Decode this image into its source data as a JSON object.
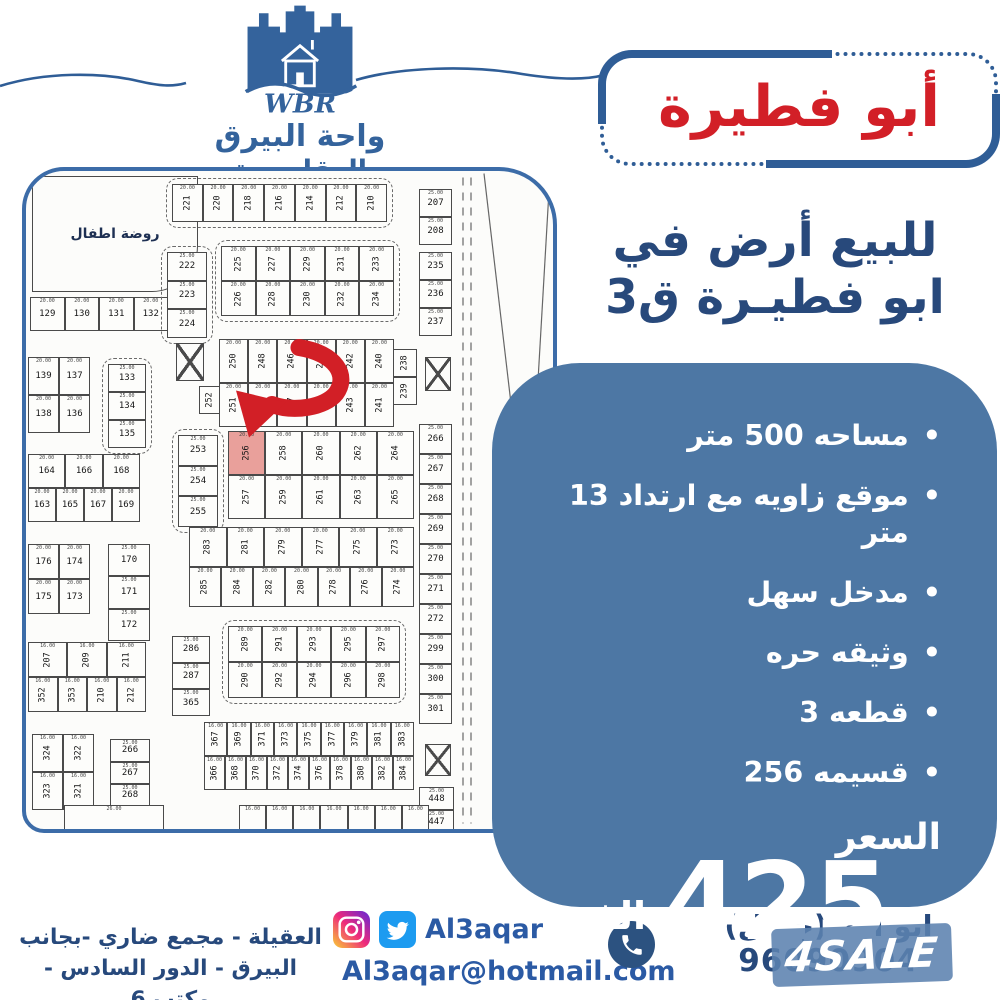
{
  "brand": {
    "initials": "WBR",
    "name_line1": "واحة البيرق",
    "name_line2": "العقاريـــة"
  },
  "title_box": {
    "text": "أبو فطيرة"
  },
  "headline": {
    "line1": "للبيع أرض في",
    "line2": "ابو فطيـرة ق3"
  },
  "panel": {
    "bullets": [
      "مساحه 500 متر",
      "موقع زاويه مع ارتداد 13 متر",
      "مدخل سهل",
      "وثيقه حره",
      "قطعه 3",
      "قسيمه 256"
    ],
    "bullet_symbol": "•",
    "price_label": "السعر",
    "price_value": "425",
    "price_unit": "الف"
  },
  "map": {
    "kindergarten_label": "روضة اطفال",
    "highlighted_plot": "256",
    "blocks": [
      {
        "type": "label",
        "x": 6,
        "y": 5,
        "w": 166,
        "h": 116,
        "label": "روضة اطفال",
        "radius": "0 0 46px 0"
      },
      {
        "x": 146,
        "y": 13,
        "w": 215,
        "h": 38,
        "rotate": true,
        "dim": "20.00",
        "dashed": true,
        "rows": [
          [
            "221",
            "220",
            "218",
            "216",
            "214",
            "212",
            "210"
          ]
        ]
      },
      {
        "x": 4,
        "y": 126,
        "w": 138,
        "h": 34,
        "dim": "20.00",
        "rows": [
          [
            "129",
            "130",
            "131",
            "132"
          ]
        ]
      },
      {
        "x": 2,
        "y": 186,
        "w": 62,
        "h": 76,
        "dim": "20.00",
        "rows": [
          [
            "139",
            "137"
          ],
          [
            "138",
            "136"
          ]
        ]
      },
      {
        "x": 141,
        "y": 81,
        "w": 40,
        "h": 86,
        "dim": "25.00",
        "dashed": true,
        "rows": [
          [
            "222"
          ],
          [
            "223"
          ],
          [
            "224"
          ]
        ]
      },
      {
        "x": 195,
        "y": 75,
        "w": 173,
        "h": 70,
        "rotate": true,
        "dim": "20.00",
        "dashed": true,
        "rows": [
          [
            "225",
            "227",
            "229",
            "231",
            "233"
          ],
          [
            "226",
            "228",
            "230",
            "232",
            "234"
          ]
        ]
      },
      {
        "x": 82,
        "y": 193,
        "w": 38,
        "h": 84,
        "dim": "25.00",
        "dashed": true,
        "rows": [
          [
            "133"
          ],
          [
            "134"
          ],
          [
            "135"
          ]
        ]
      },
      {
        "x": 2,
        "y": 283,
        "w": 112,
        "h": 68,
        "dim": "20.00",
        "rows": [
          [
            "164",
            "166",
            "168"
          ],
          [
            "163",
            "165",
            "167",
            "169"
          ]
        ]
      },
      {
        "x": 2,
        "y": 373,
        "w": 62,
        "h": 70,
        "dim": "20.00",
        "rows": [
          [
            "176",
            "174"
          ],
          [
            "175",
            "173"
          ]
        ]
      },
      {
        "x": 82,
        "y": 373,
        "w": 42,
        "h": 97,
        "dim": "25.00",
        "rows": [
          [
            "170"
          ],
          [
            "171"
          ],
          [
            "172"
          ]
        ]
      },
      {
        "x": 2,
        "y": 471,
        "w": 118,
        "h": 70,
        "rotate": true,
        "dim": "16.00",
        "rows": [
          [
            "207",
            "209",
            "211"
          ],
          [
            "352",
            "353",
            "210",
            "212"
          ]
        ]
      },
      {
        "x": 6,
        "y": 563,
        "w": 62,
        "h": 76,
        "rotate": true,
        "dim": "16.00",
        "rows": [
          [
            "324",
            "322"
          ],
          [
            "323",
            "321"
          ]
        ]
      },
      {
        "x": 84,
        "y": 568,
        "w": 40,
        "h": 90,
        "dim": "25.00",
        "rows": [
          [
            "266"
          ],
          [
            "267"
          ],
          [
            "268"
          ],
          [
            "269"
          ]
        ]
      },
      {
        "type": "xbox",
        "x": 150,
        "y": 172,
        "w": 28,
        "h": 38
      },
      {
        "x": 173,
        "y": 215,
        "w": 22,
        "h": 28,
        "rotate": true,
        "rows": [
          [
            "252"
          ]
        ]
      },
      {
        "x": 193,
        "y": 168,
        "w": 175,
        "h": 88,
        "rotate": true,
        "dim": "20.00",
        "rows": [
          [
            "250",
            "248",
            "246",
            "244",
            "242",
            "240"
          ],
          [
            "251",
            "249",
            "247",
            "245",
            "243",
            "241"
          ]
        ]
      },
      {
        "x": 367,
        "y": 178,
        "w": 24,
        "h": 56,
        "rotate": true,
        "rows": [
          [
            "238"
          ],
          [
            "239"
          ]
        ]
      },
      {
        "x": 152,
        "y": 264,
        "w": 40,
        "h": 92,
        "dim": "25.00",
        "dashed": true,
        "rows": [
          [
            "253"
          ],
          [
            "254"
          ],
          [
            "255"
          ]
        ]
      },
      {
        "x": 202,
        "y": 260,
        "w": 186,
        "h": 88,
        "rotate": true,
        "dim": "20.00",
        "rows": [
          [
            "256",
            "258",
            "260",
            "262",
            "264"
          ],
          [
            "257",
            "259",
            "261",
            "263",
            "265"
          ]
        ]
      },
      {
        "x": 163,
        "y": 356,
        "w": 225,
        "h": 80,
        "rotate": true,
        "dim": "20.00",
        "rows": [
          [
            "283",
            "281",
            "279",
            "277",
            "275",
            "273"
          ],
          [
            "285",
            "284",
            "282",
            "280",
            "278",
            "276",
            "274"
          ]
        ]
      },
      {
        "x": 146,
        "y": 465,
        "w": 38,
        "h": 80,
        "dim": "25.00",
        "rows": [
          [
            "286"
          ],
          [
            "287"
          ],
          [
            "365"
          ]
        ]
      },
      {
        "x": 202,
        "y": 455,
        "w": 172,
        "h": 72,
        "rotate": true,
        "dim": "20.00",
        "dashed": true,
        "rows": [
          [
            "289",
            "291",
            "293",
            "295",
            "297"
          ],
          [
            "290",
            "292",
            "294",
            "296",
            "298"
          ]
        ]
      },
      {
        "x": 178,
        "y": 551,
        "w": 210,
        "h": 68,
        "rotate": true,
        "dim": "16.00",
        "rows": [
          [
            "367",
            "369",
            "371",
            "373",
            "375",
            "377",
            "379",
            "381",
            "383"
          ],
          [
            "366",
            "368",
            "370",
            "372",
            "374",
            "376",
            "378",
            "380",
            "382",
            "384"
          ]
        ]
      },
      {
        "x": 393,
        "y": 18,
        "w": 33,
        "h": 56,
        "dim": "25.00",
        "rows": [
          [
            "207"
          ],
          [
            "208"
          ]
        ]
      },
      {
        "x": 393,
        "y": 81,
        "w": 33,
        "h": 84,
        "dim": "25.00",
        "rows": [
          [
            "235"
          ],
          [
            "236"
          ],
          [
            "237"
          ]
        ]
      },
      {
        "type": "xbox",
        "x": 399,
        "y": 186,
        "w": 26,
        "h": 34
      },
      {
        "x": 393,
        "y": 253,
        "w": 33,
        "h": 300,
        "dim": "25.00",
        "rows": [
          [
            "266"
          ],
          [
            "267"
          ],
          [
            "268"
          ],
          [
            "269"
          ],
          [
            "270"
          ],
          [
            "271"
          ],
          [
            "272"
          ],
          [
            "299"
          ],
          [
            "300"
          ],
          [
            "301"
          ]
        ]
      },
      {
        "type": "xbox",
        "x": 399,
        "y": 573,
        "w": 26,
        "h": 32
      },
      {
        "x": 393,
        "y": 616,
        "w": 35,
        "h": 46,
        "dim": "25.00",
        "rows": [
          [
            "448"
          ],
          [
            "447"
          ]
        ]
      },
      {
        "x": 213,
        "y": 634,
        "w": 190,
        "h": 26,
        "rotate": true,
        "dim": "16.00",
        "rows": [
          [
            "",
            "",
            "",
            "",
            "",
            "",
            ""
          ]
        ]
      },
      {
        "x": 38,
        "y": 634,
        "w": 100,
        "h": 26,
        "dim": "26.00",
        "rows": [
          [
            ""
          ]
        ]
      }
    ]
  },
  "footer": {
    "address_line1": "العقيلة - مجمع ضاري -بجانب",
    "address_line2": "البيرق - الدور السادس - مكتب 6",
    "social_handle": "Al3aqar",
    "email": "Al3aqar@hotmail.com",
    "contact_name": "ابو ادم (جمال)",
    "phone": "96090904",
    "watermark": "4SALE"
  },
  "colors": {
    "accent_blue": "#2f5d96",
    "panel_blue": "#4d77a4",
    "title_red": "#d21f27",
    "text_dark_blue": "#27497c",
    "highlight_pink": "#e9a09b"
  }
}
